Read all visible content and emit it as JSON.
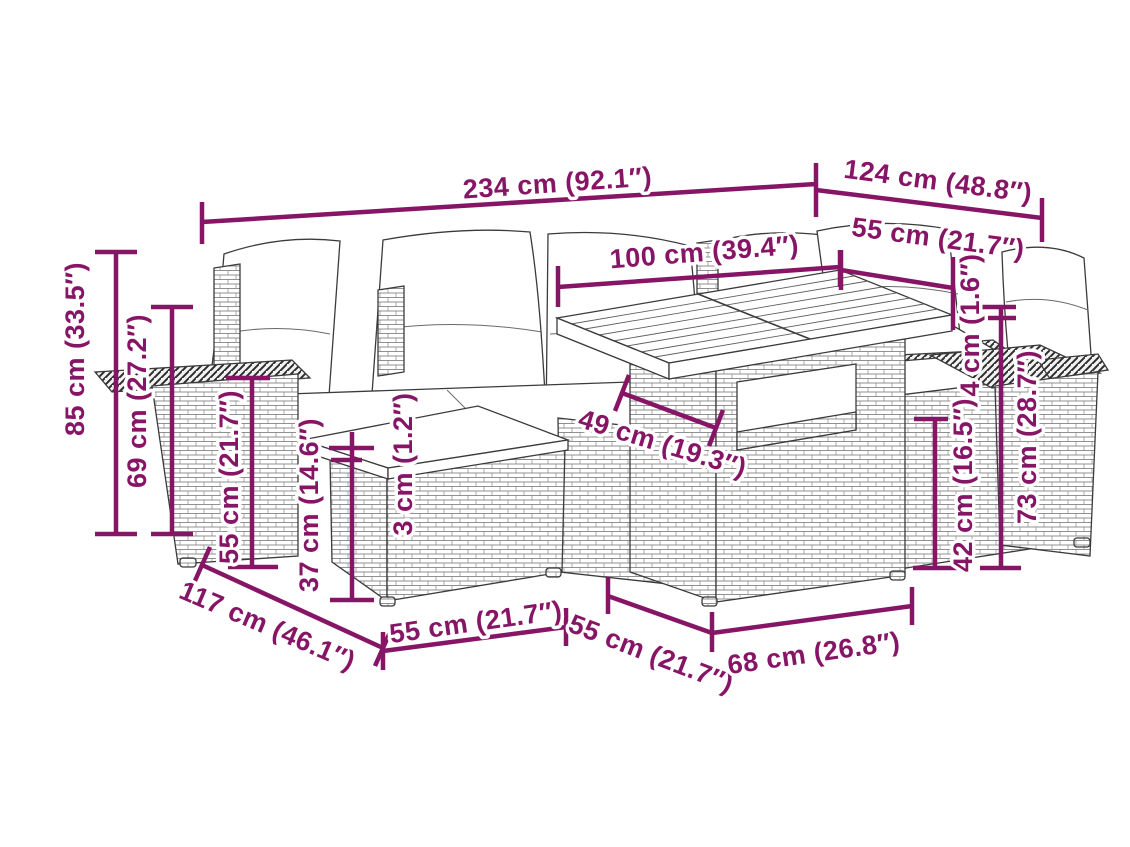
{
  "diagram": {
    "kind": "product dimension line drawing",
    "subject": "poly rattan garden lounge set with cushions, ottoman and table",
    "accent_color": "#871566",
    "outline_color": "#3b3b3b",
    "background_color": "#ffffff",
    "dimensions": [
      {
        "id": "overall-width",
        "label": "234 cm (92.1″)"
      },
      {
        "id": "depth-right",
        "label": "124 cm (48.8″)"
      },
      {
        "id": "seat-width-right",
        "label": "55 cm (21.7″)"
      },
      {
        "id": "table-length",
        "label": "100 cm (39.4″)"
      },
      {
        "id": "overall-height",
        "label": "85 cm (33.5″)"
      },
      {
        "id": "back-height",
        "label": "69 cm (27.2″)"
      },
      {
        "id": "armrest-height",
        "label": "55 cm (21.7″)"
      },
      {
        "id": "ottoman-height",
        "label": "37 cm (14.6″)"
      },
      {
        "id": "cushion-thickness",
        "label": "3 cm (1.2″)"
      },
      {
        "id": "shelf-depth",
        "label": "49 cm (19.3″)"
      },
      {
        "id": "tabletop-thickness",
        "label": "4 cm (1.6″)"
      },
      {
        "id": "table-clearance",
        "label": "42 cm (16.5″)"
      },
      {
        "id": "table-height",
        "label": "73 cm (28.7″)"
      },
      {
        "id": "depth-left",
        "label": "117 cm (46.1″)"
      },
      {
        "id": "ottoman-width",
        "label": "55 cm (21.7″)"
      },
      {
        "id": "seat-depth-front",
        "label": "55 cm (21.7″)"
      },
      {
        "id": "table-base-width",
        "label": "68 cm (26.8″)"
      }
    ]
  }
}
